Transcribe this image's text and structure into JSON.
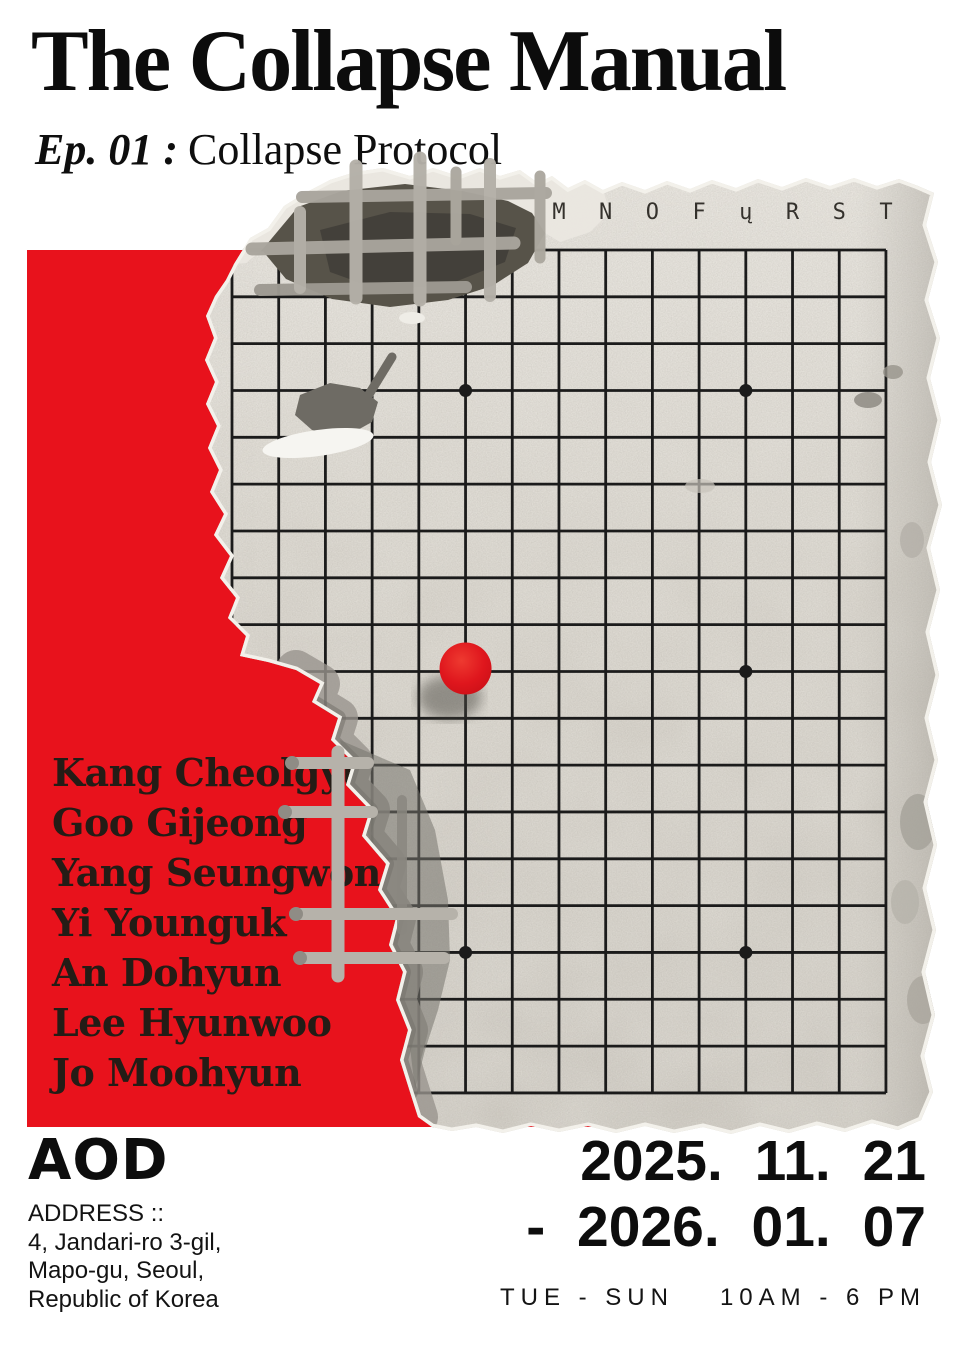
{
  "header": {
    "title": "The Collapse Manual",
    "episode_label": "Ep. 01 :",
    "episode_title": "Collapse Protocol"
  },
  "artists": [
    "Kang Cheolgyu",
    "Goo Gijeong",
    "Yang Seungwon",
    "Yi Younguk",
    "An Dohyun",
    "Lee Hyunwoo",
    "Jo Moohyun"
  ],
  "board": {
    "column_labels": [
      "M",
      "N",
      "O",
      "F",
      "ų",
      "R",
      "S",
      "T"
    ],
    "label_start_col": 7,
    "cols": 15,
    "rows": 19,
    "origin": {
      "x": 232,
      "y": 250
    },
    "cell": {
      "x": 46.71,
      "y": 46.83
    },
    "star_points": [
      [
        5,
        3
      ],
      [
        11,
        3
      ],
      [
        11,
        9
      ],
      [
        5,
        15
      ],
      [
        11,
        15
      ]
    ],
    "stone": {
      "col": 5,
      "row": 9
    }
  },
  "footer": {
    "logo": "AOD",
    "address_label": "ADDRESS ::",
    "address_lines": [
      "4, Jandari-ro 3-gil,",
      "Mapo-gu, Seoul,",
      "Republic of Korea"
    ],
    "dates": {
      "from": "2025. 11. 21",
      "to": "- 2026. 01. 07"
    },
    "hours": {
      "days": "TUE - SUN",
      "time": "10AM - 6 PM"
    }
  },
  "colors": {
    "red": "#e8121c",
    "stone": "#de1219",
    "grid_line": "#1b1b1b",
    "ink": "#111111",
    "concrete": "#d8d4cc"
  }
}
